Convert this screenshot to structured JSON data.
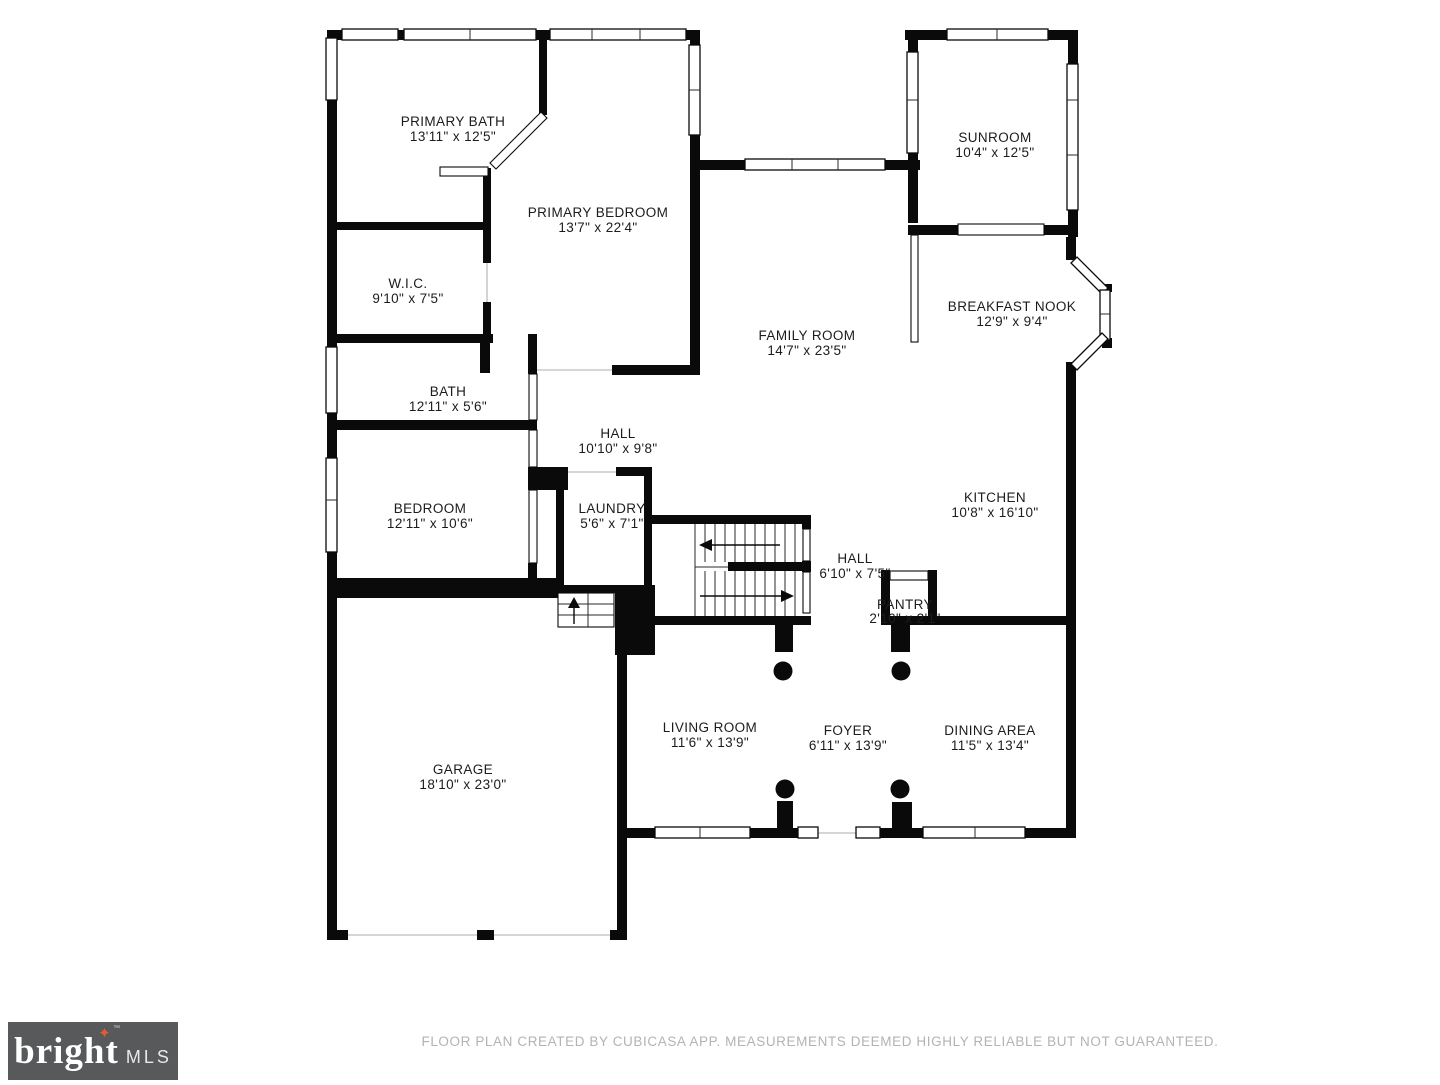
{
  "meta": {
    "footer": "FLOOR PLAN CREATED BY CUBICASA APP. MEASUREMENTS DEEMED HIGHLY RELIABLE BUT NOT GUARANTEED."
  },
  "logo": {
    "brand": "bright",
    "suffix": "MLS",
    "tm": "™",
    "star": "✦"
  },
  "colors": {
    "wall": "#0a0a0a",
    "label_text": "#1c1c1c",
    "footer_text": "#b3b3b3",
    "logo_background": "#58595b",
    "logo_star": "#e25b33",
    "logo_text": "#ffffff"
  },
  "rooms": [
    {
      "name": "PRIMARY BATH",
      "dims": "13'11\" x 12'5\""
    },
    {
      "name": "PRIMARY BEDROOM",
      "dims": "13'7\" x 22'4\""
    },
    {
      "name": "W.I.C.",
      "dims": "9'10\" x 7'5\""
    },
    {
      "name": "BATH",
      "dims": "12'11\" x 5'6\""
    },
    {
      "name": "BEDROOM",
      "dims": "12'11\" x 10'6\""
    },
    {
      "name": "HALL",
      "dims": "10'10\" x 9'8\""
    },
    {
      "name": "LAUNDRY",
      "dims": "5'6\" x 7'1\""
    },
    {
      "name": "FAMILY ROOM",
      "dims": "14'7\" x 23'5\""
    },
    {
      "name": "SUNROOM",
      "dims": "10'4\" x 12'5\""
    },
    {
      "name": "BREAKFAST NOOK",
      "dims": "12'9\" x 9'4\""
    },
    {
      "name": "KITCHEN",
      "dims": "10'8\" x 16'10\""
    },
    {
      "name": "HALL",
      "dims": "6'10\" x 7'5\""
    },
    {
      "name": "PANTRY",
      "dims": "2'10\" x 2'1\""
    },
    {
      "name": "GARAGE",
      "dims": "18'10\" x 23'0\""
    },
    {
      "name": "LIVING ROOM",
      "dims": "11'6\" x 13'9\""
    },
    {
      "name": "FOYER",
      "dims": "6'11\" x 13'9\""
    },
    {
      "name": "DINING AREA",
      "dims": "11'5\" x 13'4\""
    }
  ]
}
